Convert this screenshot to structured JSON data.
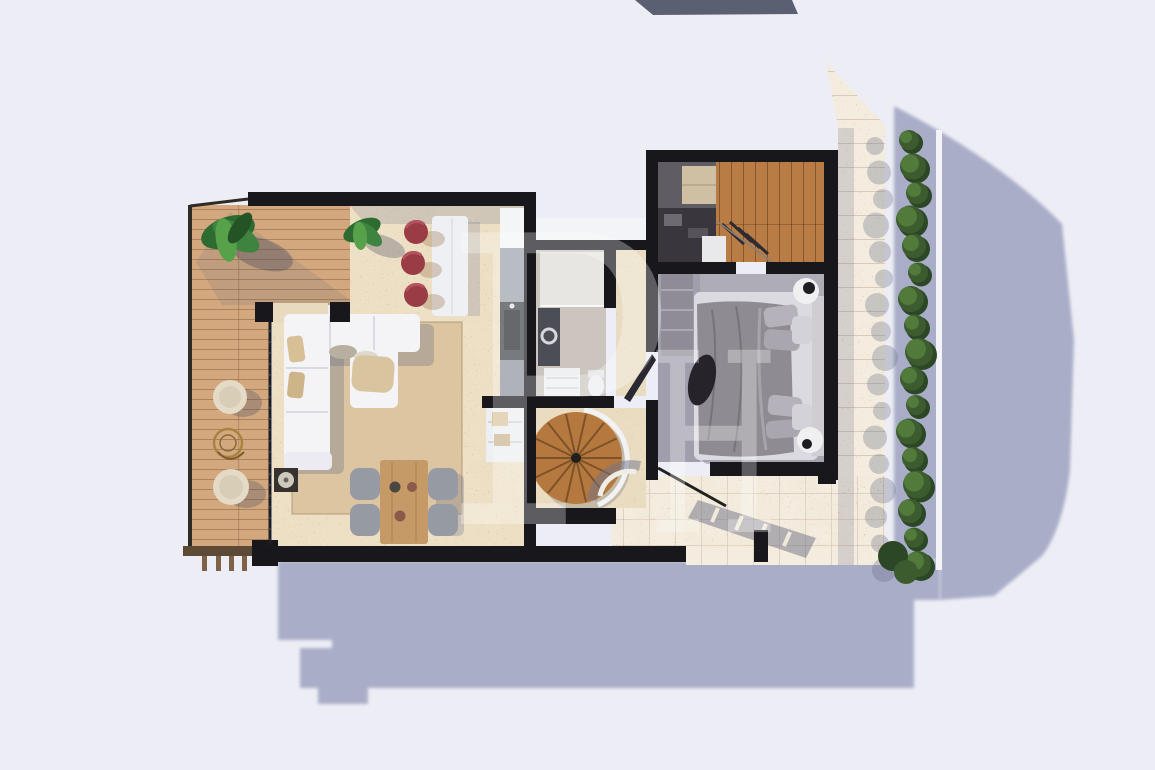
{
  "scene": {
    "type": "architectural floor plan 3D render, top-down view",
    "watermark": {
      "letter_1": "P",
      "letter_2": "H"
    }
  },
  "palette": {
    "background": "#edeef5",
    "cast_shadow": "#a9adc8",
    "wall": "#17171c",
    "roof_slab": "#5b5f72",
    "travertine_floor": "#ecdfc4",
    "terrace_stone": "#f3ecdf",
    "speckle": "#b9714d",
    "deck_wood": "#d3a87e",
    "closet_wood": "#b97c44",
    "stair_wood": "#b5793f",
    "rug": "#dcc5a0",
    "sofa": "#f4f4f7",
    "bar_stool_red": "#9a3c45",
    "counter_dark": "#3c4047",
    "bath_floor": "#cbc5be",
    "bedroom_floor": "#c9c7cf",
    "bed_duvet": "#8e8b92",
    "hedge_green": "#2c4726",
    "hedge_light": "#527a3a",
    "dining_table": "#c59a66",
    "chair_gray": "#959aa3"
  },
  "counts": {
    "bar_stools": 3,
    "dining_chairs": 4,
    "deck_poufs": 2,
    "deck_posts": 4,
    "hedge_bushes": 17,
    "stair_treads": 14,
    "bed_pillows": 6
  },
  "rooms": [
    {
      "name": "wood deck terrace",
      "furniture": [
        "potted plant",
        "two round poufs",
        "wire side table"
      ]
    },
    {
      "name": "living room",
      "furniture": [
        "L-shaped white sectional sofa",
        "area rug",
        "pouf",
        "side table"
      ]
    },
    {
      "name": "dining area",
      "furniture": [
        "wood dining table",
        "four gray chairs"
      ]
    },
    {
      "name": "kitchen",
      "furniture": [
        "white island",
        "three red bar stools",
        "counter with sink",
        "potted plant"
      ]
    },
    {
      "name": "bathroom",
      "furniture": [
        "shower",
        "vanity",
        "toilet"
      ]
    },
    {
      "name": "stair hall",
      "furniture": [
        "spiral staircase"
      ]
    },
    {
      "name": "walk-in closet",
      "furniture": [
        "wardrobe shelving",
        "hanging clothes",
        "white cabinet"
      ]
    },
    {
      "name": "bedroom",
      "furniture": [
        "double bed",
        "two round nightstands",
        "dark throw"
      ]
    },
    {
      "name": "stone patio",
      "furniture": [
        "leaning rail",
        "railing shadow"
      ]
    },
    {
      "name": "green hedge",
      "furniture": []
    }
  ]
}
